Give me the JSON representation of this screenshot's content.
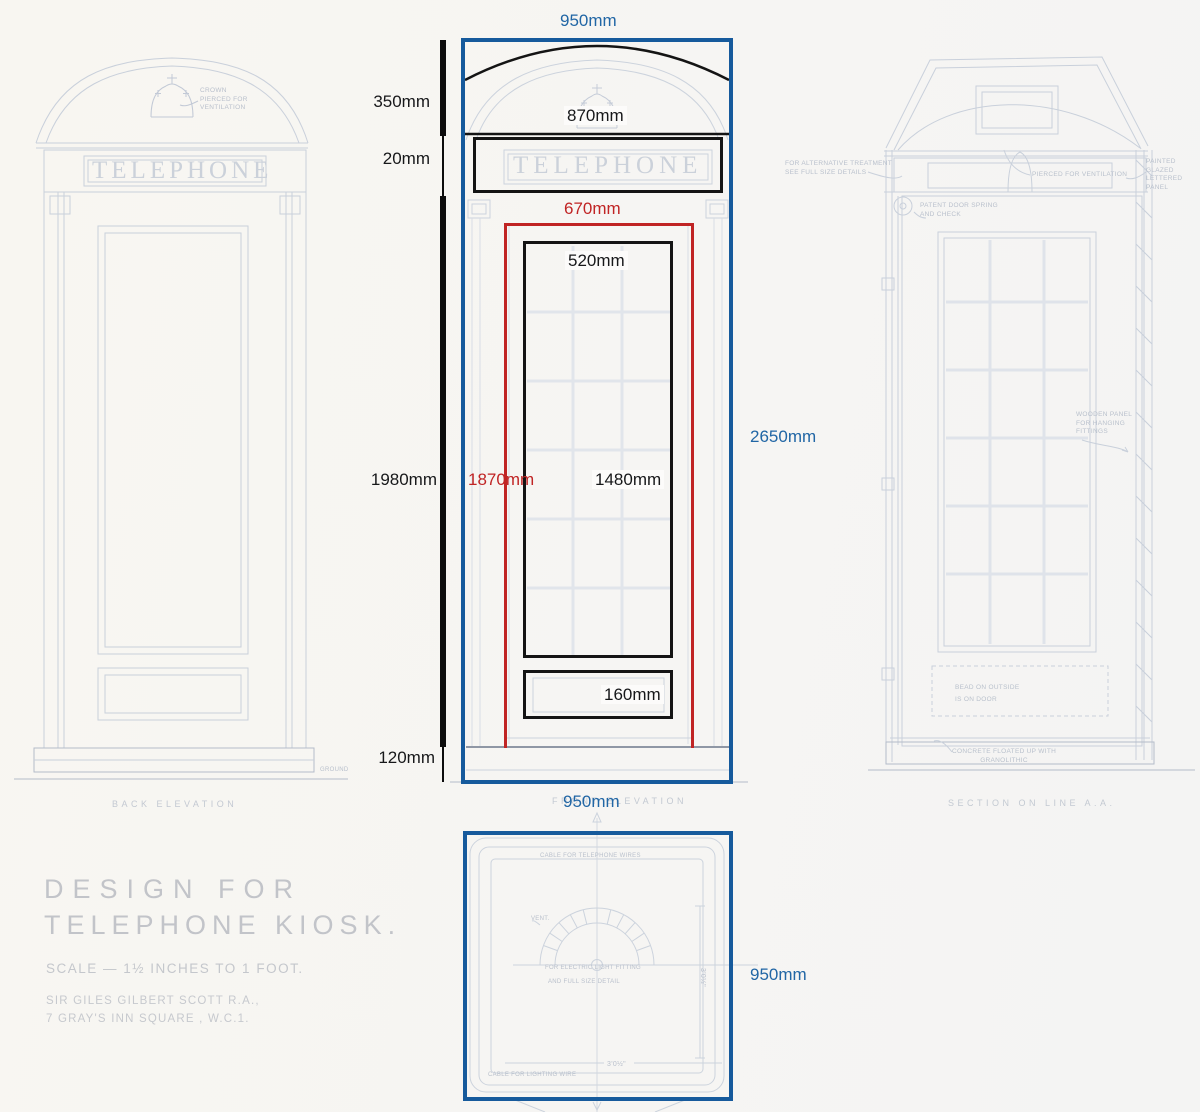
{
  "colors": {
    "overlay_blue": "#165a9c",
    "dimension_blue": "#2166a5",
    "dimension_red": "#c02424",
    "dimension_black": "#141414",
    "faint_line": "#c9d0db"
  },
  "dimensions": {
    "top_width": "950mm",
    "roof_height": "350mm",
    "sign_band_height": "20mm",
    "dome_inner_width": "870mm",
    "door_frame_width": "670mm",
    "glazing_width": "520mm",
    "body_height": "1980mm",
    "door_height": "1870mm",
    "glazing_height": "1480mm",
    "overall_height": "2650mm",
    "kick_panel_height": "160mm",
    "plinth_height": "120mm",
    "bottom_width": "950mm",
    "plan_depth": "950mm"
  },
  "views": {
    "back": {
      "label": "BACK  ELEVATION"
    },
    "front": {
      "label": "FRONT  ELEVATION"
    },
    "section": {
      "label": "SECTION  ON  LINE  A.A."
    }
  },
  "signs": {
    "telephone": "TELEPHONE"
  },
  "annotations": {
    "crown_note": "CROWN\nPIERCED FOR\nVENTILATION",
    "alt_treatment": "FOR ALTERNATIVE TREATMENT\nSEE FULL SIZE DETAILS",
    "pierced": "PIERCED  FOR  VENTILATION",
    "glazed_panel": "PAINTED GLAZED\nLETTERED PANEL",
    "door_spring": "PATENT DOOR SPRING\nAND CHECK",
    "wooden_panel": "WOODEN PANEL\nFOR HANGING\nFITTINGS",
    "bead": "BEAD ON  OUTSIDE\nIS ON  DOOR",
    "concrete": "CONCRETE  FLOATED  UP  WITH\nGRANOLITHIC",
    "ground": "GROUND",
    "plan_cable_top": "CABLE FOR  TELEPHONE  WIRES",
    "plan_vent": "VENT.",
    "plan_light": "FOR  ELECTRIC  LIGHT  FITTING",
    "plan_detail": "AND  FULL  SIZE  DETAIL",
    "plan_cable_bottom": "CABLE FOR  LIGHTING  WIRE",
    "plan_dim_bottom": "3'0½\"",
    "plan_dim_side": "3'0½\""
  },
  "title_block": {
    "line1": "DESIGN   FOR",
    "line2": "TELEPHONE  KIOSK.",
    "scale": "SCALE — 1½ INCHES  TO 1 FOOT.",
    "architect": "SIR  GILES  GILBERT  SCOTT  R.A.,",
    "address": "7  GRAY'S  INN   SQUARE , W.C.1."
  }
}
